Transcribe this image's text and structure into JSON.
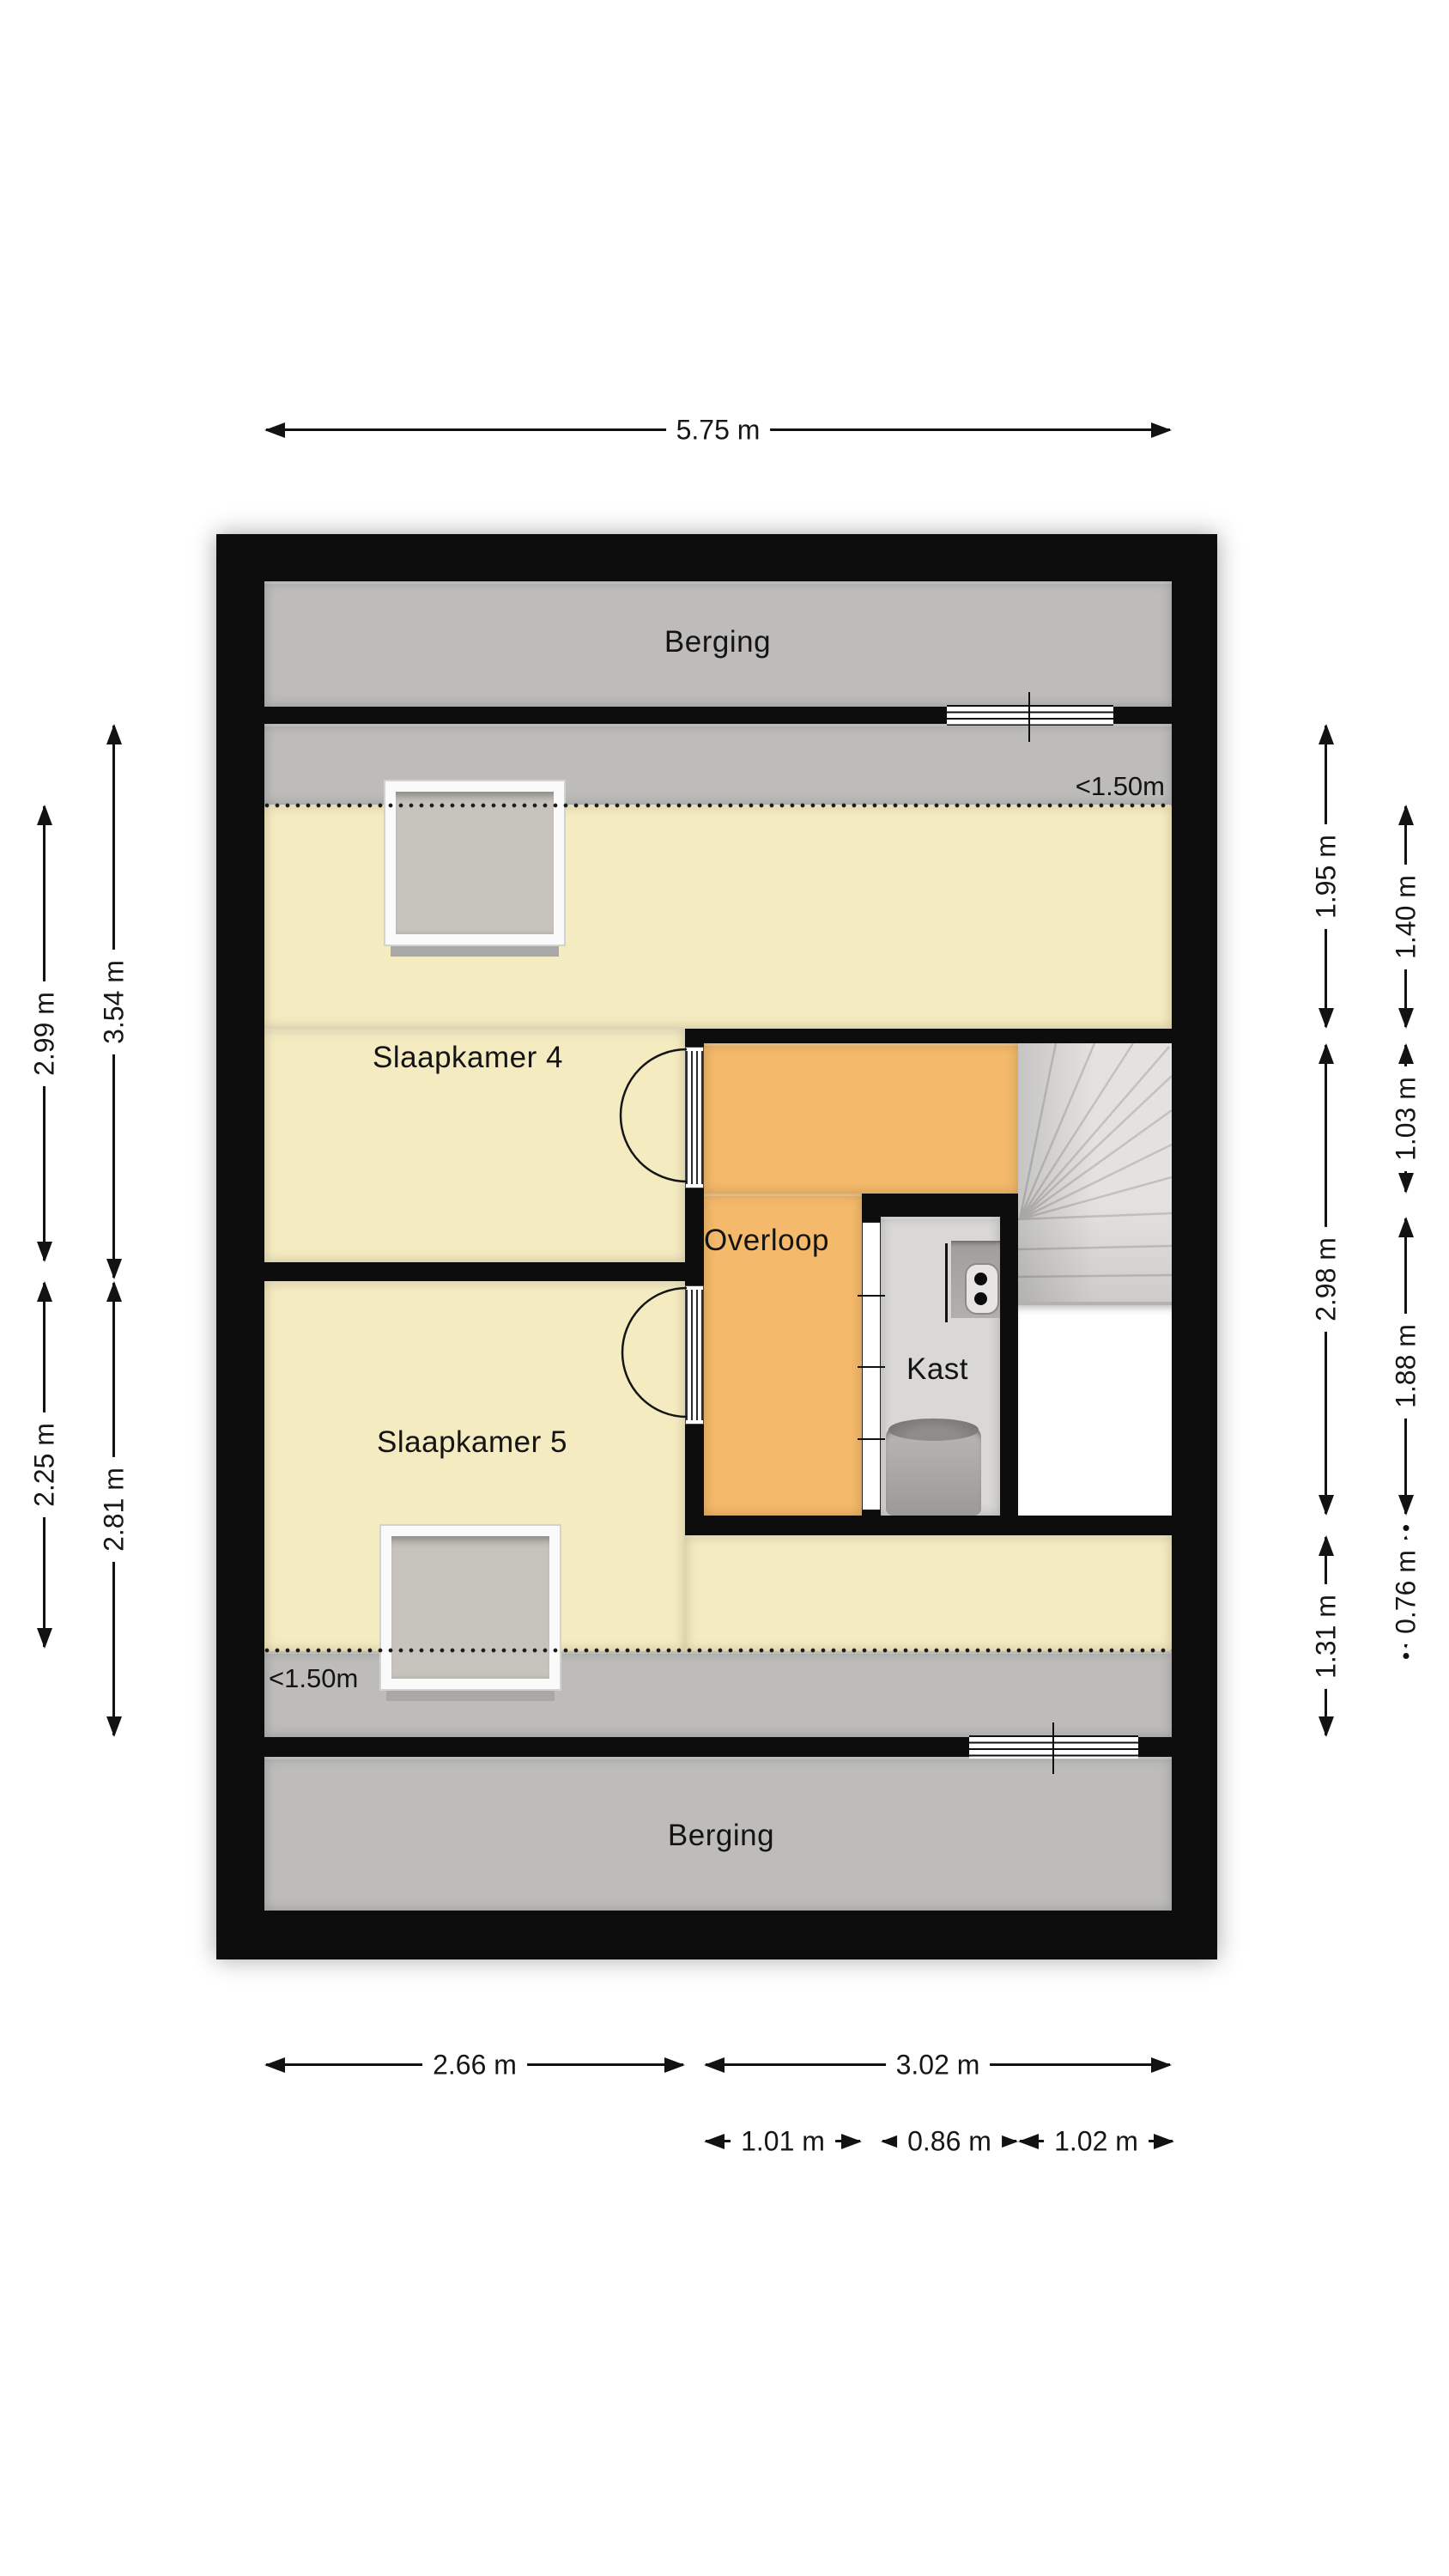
{
  "floorplan": {
    "rooms": {
      "berging_top": {
        "label": "Berging"
      },
      "slaapkamer_4": {
        "label": "Slaapkamer 4"
      },
      "overloop": {
        "label": "Overloop"
      },
      "kast": {
        "label": "Kast"
      },
      "slaapkamer_5": {
        "label": "Slaapkamer 5"
      },
      "berging_bottom": {
        "label": "Berging"
      }
    },
    "height_markers": {
      "top": {
        "label": "<1.50m"
      },
      "bottom": {
        "label": "<1.50m"
      }
    },
    "features": [
      "stairs",
      "skylight-slaapkamer4",
      "skylight-slaapkamer5",
      "boiler",
      "ventilation-unit",
      "window-top-wall",
      "window-bottom-wall",
      "door-slaapkamer4",
      "door-slaapkamer5",
      "kast-door"
    ]
  },
  "dimensions": {
    "top_total_width": {
      "label": "5.75 m",
      "meters": 5.75
    },
    "left_outer_upper": {
      "label": "2.99 m",
      "meters": 2.99
    },
    "left_outer_lower": {
      "label": "2.25 m",
      "meters": 2.25
    },
    "left_inner_upper": {
      "label": "3.54 m",
      "meters": 3.54
    },
    "left_inner_lower": {
      "label": "2.81 m",
      "meters": 2.81
    },
    "right_inner_upper": {
      "label": "1.95 m",
      "meters": 1.95
    },
    "right_inner_middle": {
      "label": "2.98 m",
      "meters": 2.98
    },
    "right_inner_lower": {
      "label": "1.31 m",
      "meters": 1.31
    },
    "right_outer_1": {
      "label": "1.40 m",
      "meters": 1.4
    },
    "right_outer_2": {
      "label": "1.03 m",
      "meters": 1.03
    },
    "right_outer_3": {
      "label": "1.88 m",
      "meters": 1.88
    },
    "right_outer_4": {
      "label": "0.76 m",
      "meters": 0.76
    },
    "bottom_left_width": {
      "label": "2.66 m",
      "meters": 2.66
    },
    "bottom_right_width": {
      "label": "3.02 m",
      "meters": 3.02
    },
    "bottom_sub_1": {
      "label": "1.01 m",
      "meters": 1.01
    },
    "bottom_sub_2": {
      "label": "0.86 m",
      "meters": 0.86
    },
    "bottom_sub_3": {
      "label": "1.02 m",
      "meters": 1.02
    }
  },
  "colors": {
    "wall": "#0d0d0d",
    "room_yellow": "#f5ebc1",
    "room_orange": "#f4b96a",
    "room_gray": "#bdbcba",
    "kast_gray": "#d9d8d6",
    "stairs_gray": "#e3e2e0",
    "skylight_glass": "#c6c3bc",
    "background": "#ffffff"
  }
}
